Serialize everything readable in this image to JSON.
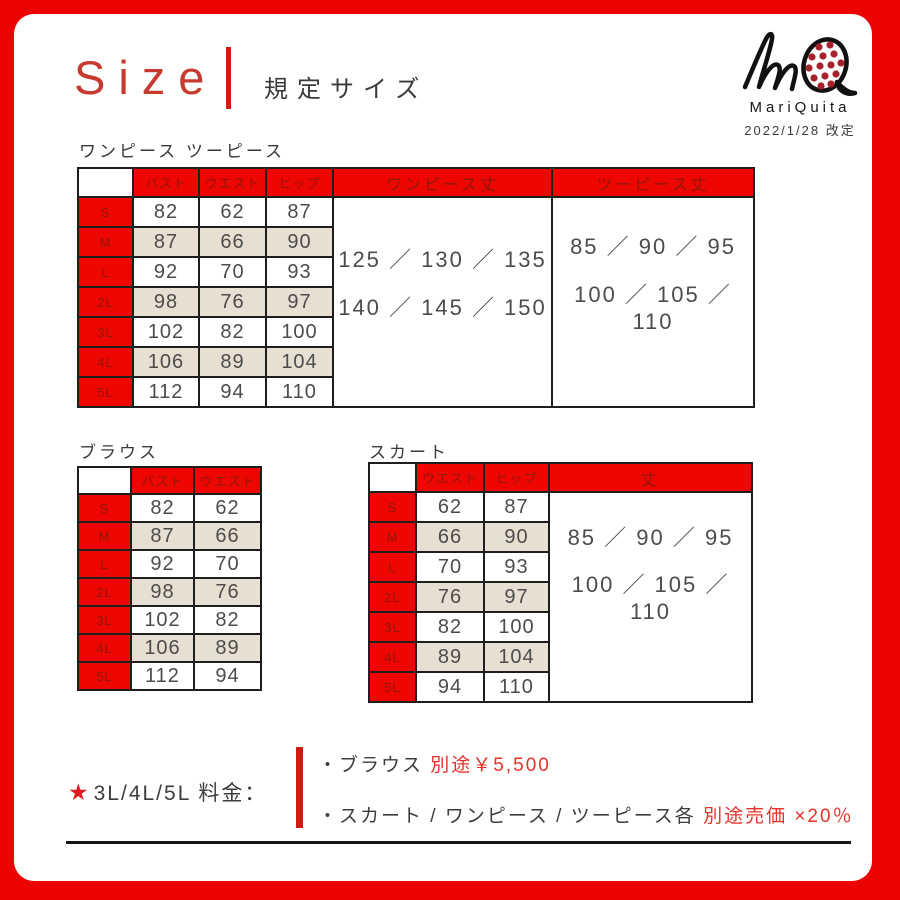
{
  "page": {
    "title": "Size",
    "subtitle": "規定サイズ"
  },
  "logo": {
    "monogram": "MQ",
    "name": "MariQuita",
    "revision_date": "2022/1/28 改定",
    "dot_color": "#a7212c"
  },
  "tables": {
    "onepiece_twopiece": {
      "label": "ワンピース ツーピース",
      "columns": [
        "バスト",
        "ウエスト",
        "ヒップ"
      ],
      "sizes": [
        "S",
        "M",
        "L",
        "2L",
        "3L",
        "4L",
        "5L"
      ],
      "rows": [
        [
          82,
          62,
          87
        ],
        [
          87,
          66,
          90
        ],
        [
          92,
          70,
          93
        ],
        [
          98,
          76,
          97
        ],
        [
          102,
          82,
          100
        ],
        [
          106,
          89,
          104
        ],
        [
          112,
          94,
          110
        ]
      ],
      "merged_columns": [
        {
          "header": "ワンピース丈",
          "lines": [
            "125 ／ 130 ／ 135",
            "140 ／ 145 ／ 150"
          ]
        },
        {
          "header": "ツーピース丈",
          "lines": [
            "85 ／ 90 ／ 95",
            "100 ／ 105 ／ 110"
          ]
        }
      ]
    },
    "blouse": {
      "label": "ブラウス",
      "columns": [
        "バスト",
        "ウエスト"
      ],
      "sizes": [
        "S",
        "M",
        "L",
        "2L",
        "3L",
        "4L",
        "5L"
      ],
      "rows": [
        [
          82,
          62
        ],
        [
          87,
          66
        ],
        [
          92,
          70
        ],
        [
          98,
          76
        ],
        [
          102,
          82
        ],
        [
          106,
          89
        ],
        [
          112,
          94
        ]
      ],
      "merged_columns": []
    },
    "skirt": {
      "label": "スカート",
      "columns": [
        "ウエスト",
        "ヒップ"
      ],
      "sizes": [
        "S",
        "M",
        "L",
        "2L",
        "3L",
        "4L",
        "5L"
      ],
      "rows": [
        [
          62,
          87
        ],
        [
          66,
          90
        ],
        [
          70,
          93
        ],
        [
          76,
          97
        ],
        [
          82,
          100
        ],
        [
          89,
          104
        ],
        [
          94,
          110
        ]
      ],
      "merged_columns": [
        {
          "header": "丈",
          "lines": [
            "85 ／ 90 ／ 95",
            "100 ／ 105 ／ 110"
          ]
        }
      ]
    }
  },
  "notes": {
    "star": "★",
    "heading": "3L/4L/5L 料金：",
    "items": [
      {
        "prefix": "・ブラウス ",
        "highlight": "別途￥5,500"
      },
      {
        "prefix": "・スカート / ワンピース / ツーピース各 ",
        "highlight": "別途売価 ×20％"
      }
    ]
  },
  "colors": {
    "frame_red": "#ec0401",
    "header_red": "#ee0600",
    "dark_red_text": "#8f170a",
    "row_beige": "#e7dfd2",
    "accent_red": "#e73229",
    "text_dark": "#4c4c4c"
  }
}
